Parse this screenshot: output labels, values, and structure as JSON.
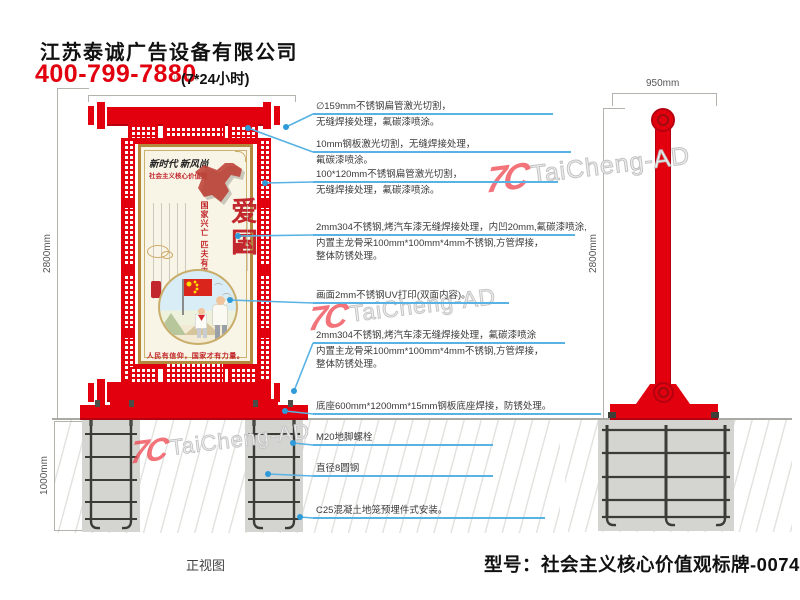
{
  "header": {
    "company": "江苏泰诚广告设备有限公司",
    "phone": "400-799-7880",
    "hotline": "(7*24小时)",
    "dim_fragment": "00mm"
  },
  "watermark": {
    "logo": "7C",
    "text": "TaiCheng-AD"
  },
  "front_view": {
    "label": "正视图",
    "dims": {
      "height": "2800mm",
      "underground": "1000mm"
    },
    "callouts": [
      {
        "l1": "∅159mm不锈钢扁管激光切割，",
        "l2": "无缝焊接处理，氟碳漆喷涂。"
      },
      {
        "l1": "10mm钢板激光切割，无缝焊接处理，",
        "l2": "氟碳漆喷涂。"
      },
      {
        "l1": "100*120mm不锈钢扁管激光切割，",
        "l2": "无缝焊接处理，氟碳漆喷涂。"
      },
      {
        "l1": "2mm304不锈钢,烤汽车漆无缝焊接处理，内凹20mm,氟碳漆喷涂,",
        "l2": "内置主龙骨采100mm*100mm*4mm不锈钢,方管焊接，",
        "l3": "整体防锈处理。"
      },
      {
        "l1": "画面2mm不锈钢UV打印(双面内容)。"
      },
      {
        "l1": "2mm304不锈钢,烤汽车漆无缝焊接处理，氟碳漆喷涂",
        "l2": "内置主龙骨采100mm*100mm*4mm不锈钢,方管焊接，",
        "l3": "整体防锈处理。"
      },
      {
        "l1": "底座600mm*1200mm*15mm钢板底座焊接，防锈处理。"
      },
      {
        "l1": "M20地脚螺栓"
      },
      {
        "l1": "直径8圆钢"
      },
      {
        "l1": "C25混凝土地笼预埋件式安装。"
      }
    ]
  },
  "side_view": {
    "dims": {
      "width": "950mm",
      "height": "2800mm"
    }
  },
  "poster": {
    "calligraphy": "新时代 新风尚",
    "subtitle": "社会主义核心价值观",
    "title": "爱国",
    "motto": "国家兴亡  匹夫有责",
    "slogan": "人民有信仰，国家才有力量。"
  },
  "footer": {
    "model": "型号：社会主义核心价值观标牌-0074"
  },
  "colors": {
    "red": "#e2000f",
    "callout_blue": "#58b2e3",
    "poster_red": "#c2272d"
  }
}
